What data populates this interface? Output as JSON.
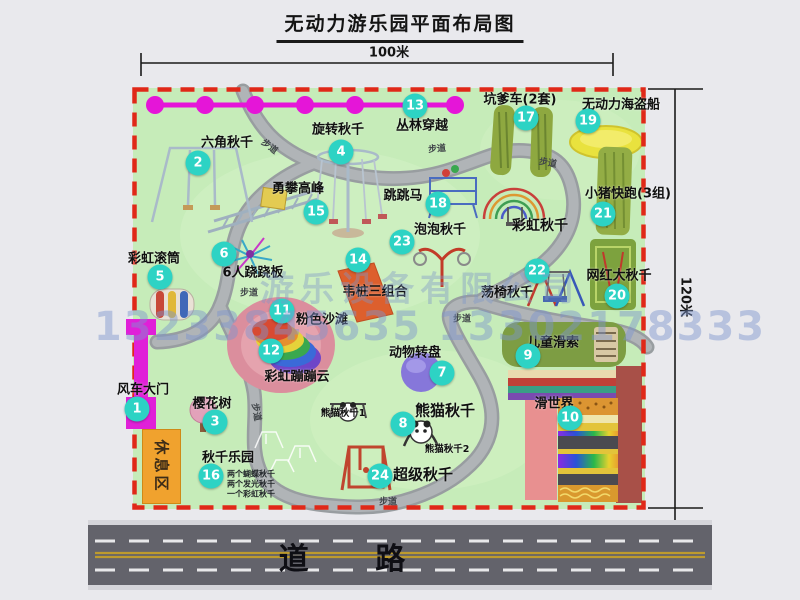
{
  "title": "无动力游乐园平面布局图",
  "dimensions": {
    "horizontal": "100米",
    "vertical": "120米"
  },
  "road": {
    "label": "道 路"
  },
  "watermark": {
    "company": "游乐设备有限公司",
    "phone": "13233845635 13302178333"
  },
  "rest_area": {
    "label": "休息区"
  },
  "park": {
    "path_label_text": "步道",
    "path_label_positions": [
      [
        270,
        146,
        38
      ],
      [
        437,
        148,
        -5
      ],
      [
        548,
        162,
        10
      ],
      [
        249,
        292,
        0
      ],
      [
        462,
        318,
        0
      ],
      [
        257,
        412,
        80
      ],
      [
        388,
        501,
        0
      ]
    ],
    "items": [
      {
        "n": "1",
        "t": "风车大门",
        "b": [
          137,
          409
        ],
        "l": [
          143,
          388
        ]
      },
      {
        "n": "2",
        "t": "六角秋千",
        "b": [
          198,
          163
        ],
        "l": [
          227,
          141
        ]
      },
      {
        "n": "3",
        "t": "樱花树",
        "b": [
          215,
          422
        ],
        "l": [
          212,
          402
        ]
      },
      {
        "n": "4",
        "t": "旋转秋千",
        "b": [
          341,
          152
        ],
        "l": [
          338,
          128
        ]
      },
      {
        "n": "5",
        "t": "彩虹滚筒",
        "b": [
          160,
          277
        ],
        "l": [
          154,
          257
        ]
      },
      {
        "n": "6",
        "t": "6人跷跷板",
        "b": [
          224,
          254
        ],
        "l": [
          253,
          271
        ]
      },
      {
        "n": "7",
        "t": "动物转盘",
        "b": [
          442,
          373
        ],
        "l": [
          415,
          351
        ]
      },
      {
        "n": "8",
        "t": "熊猫秋千",
        "b": [
          403,
          424
        ],
        "l": [
          445,
          410
        ],
        "s": 15
      },
      {
        "n": "9",
        "t": "儿童滑索",
        "b": [
          528,
          356
        ],
        "l": [
          553,
          341
        ]
      },
      {
        "n": "10",
        "t": "滑世界",
        "b": [
          570,
          418
        ],
        "l": [
          554,
          402
        ]
      },
      {
        "n": "11",
        "t": "粉色沙滩",
        "b": [
          282,
          311
        ],
        "l": [
          322,
          318
        ]
      },
      {
        "n": "12",
        "t": "彩虹蹦蹦云",
        "b": [
          271,
          351
        ],
        "l": [
          297,
          375
        ]
      },
      {
        "n": "13",
        "t": "丛林穿越",
        "b": [
          415,
          106
        ],
        "l": [
          422,
          124
        ]
      },
      {
        "n": "14",
        "t": "韦桩三组合",
        "b": [
          358,
          260
        ],
        "l": [
          375,
          290
        ]
      },
      {
        "n": "15",
        "t": "勇攀高峰",
        "b": [
          316,
          212
        ],
        "l": [
          298,
          187
        ]
      },
      {
        "n": "16",
        "t": "秋千乐园",
        "b": [
          211,
          476
        ],
        "l": [
          228,
          456
        ]
      },
      {
        "n": "17",
        "t": "坑爹车(2套)",
        "b": [
          526,
          118
        ],
        "l": [
          520,
          98
        ]
      },
      {
        "n": "18",
        "t": "跳跳马",
        "b": [
          438,
          204
        ],
        "l": [
          403,
          194
        ]
      },
      {
        "n": "19",
        "t": "无动力海盗船",
        "b": [
          588,
          121
        ],
        "l": [
          621,
          103
        ]
      },
      {
        "n": "20",
        "t": "网红大秋千",
        "b": [
          617,
          296
        ],
        "l": [
          619,
          274
        ]
      },
      {
        "n": "21",
        "t": "小猪快跑(3组)",
        "b": [
          603,
          214
        ],
        "l": [
          628,
          192
        ]
      },
      {
        "n": "22",
        "t": "荡椅秋千",
        "b": [
          537,
          271
        ],
        "l": [
          507,
          291
        ]
      },
      {
        "n": "23",
        "t": "泡泡秋千",
        "b": [
          402,
          242
        ],
        "l": [
          440,
          228
        ]
      },
      {
        "n": "24",
        "t": "超级秋千",
        "b": [
          380,
          476
        ],
        "l": [
          423,
          474
        ],
        "s": 15
      }
    ],
    "extra_labels": [
      {
        "t": "彩虹秋千",
        "x": 540,
        "y": 225,
        "s": 14
      },
      {
        "t": "熊猫秋千1",
        "x": 343,
        "y": 412,
        "s": 9.5
      },
      {
        "t": "熊猫秋千2",
        "x": 447,
        "y": 448,
        "s": 9.5
      }
    ],
    "swing_notes": [
      {
        "t": "两个蝴蝶秋千",
        "x": 251,
        "y": 474
      },
      {
        "t": "两个发光秋千",
        "x": 251,
        "y": 484
      },
      {
        "t": "一个彩虹秋千",
        "x": 251,
        "y": 494
      }
    ]
  }
}
